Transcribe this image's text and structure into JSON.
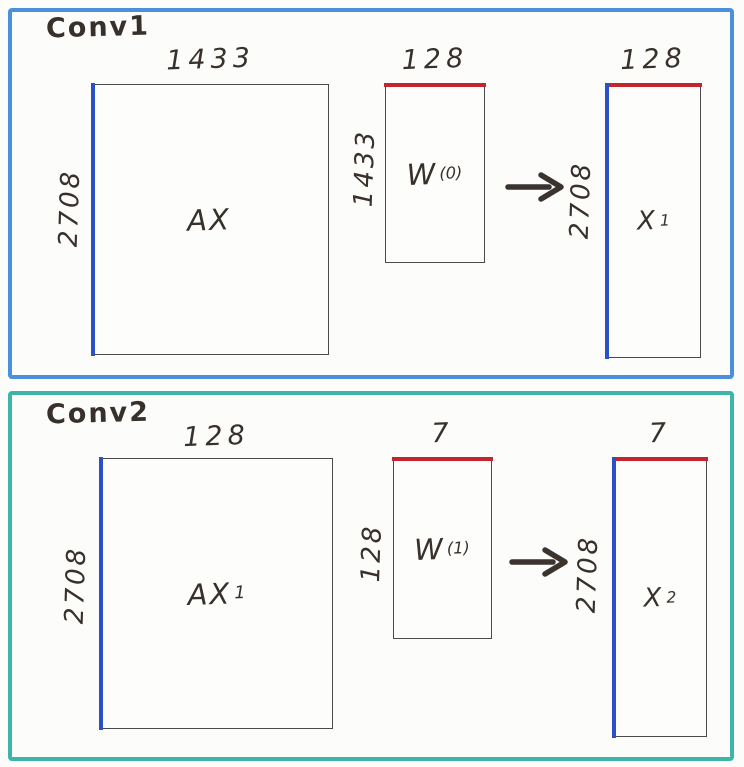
{
  "colors": {
    "ink": "#38302b",
    "panel1_border": "#4a90dc",
    "panel2_border": "#3db5a9",
    "row_edge_blue": "#2a52c6",
    "col_edge_red": "#c3242e",
    "box_border": "#4a4a4a"
  },
  "panels": [
    {
      "title": "Conv1",
      "matrices": [
        {
          "base": "AX",
          "sup": "",
          "sub": "",
          "top_dim": "1433",
          "side_dim": "2708"
        },
        {
          "base": "W",
          "sup": "(0)",
          "sub": "",
          "top_dim": "128",
          "side_dim": "1433"
        },
        {
          "base": "X",
          "sup": "",
          "sub": "1",
          "top_dim": "128",
          "side_dim": "2708"
        }
      ]
    },
    {
      "title": "Conv2",
      "matrices": [
        {
          "base": "AX",
          "sup": "",
          "sub": "1",
          "top_dim": "128",
          "side_dim": "2708"
        },
        {
          "base": "W",
          "sup": "(1)",
          "sub": "",
          "top_dim": "7",
          "side_dim": "128"
        },
        {
          "base": "X",
          "sup": "",
          "sub": "2",
          "top_dim": "7",
          "side_dim": "2708"
        }
      ]
    }
  ]
}
